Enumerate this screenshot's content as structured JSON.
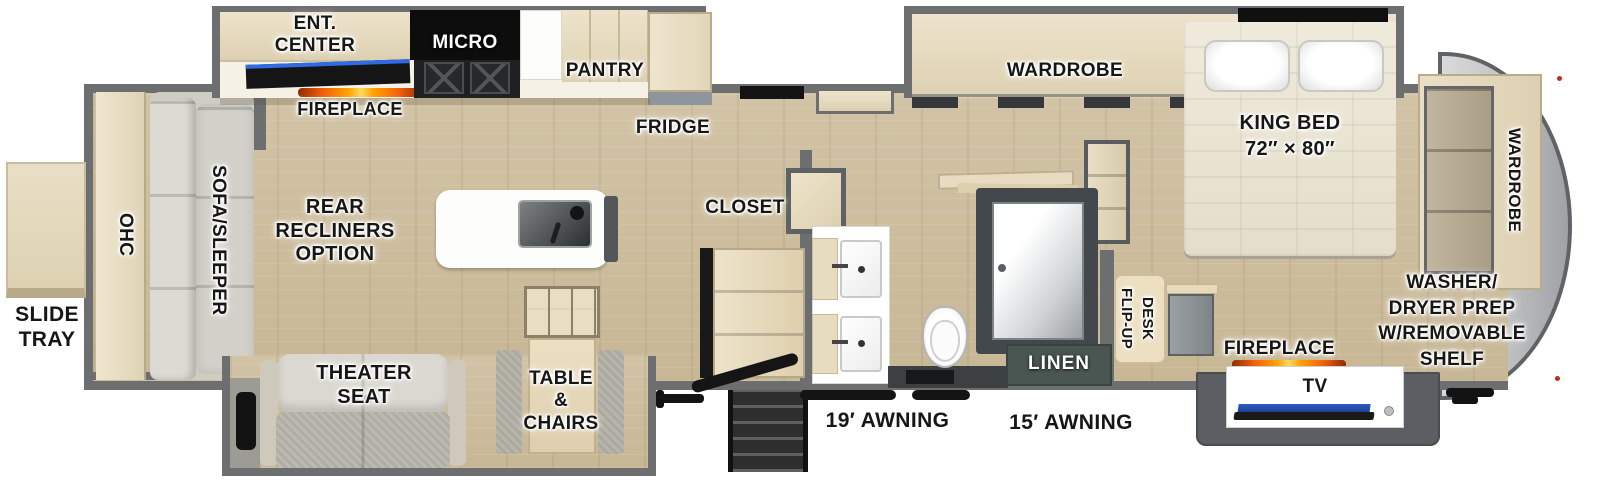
{
  "labels": {
    "slide_tray": "SLIDE\nTRAY",
    "ohc": "OHC",
    "sofa_sleeper": "SOFA/SLEEPER",
    "ent_center": "ENT.\nCENTER",
    "fireplace_kitchen": "FIREPLACE",
    "micro": "MICRO",
    "pantry": "PANTRY",
    "fridge": "FRIDGE",
    "rear_recliners": "REAR\nRECLINERS\nOPTION",
    "closet": "CLOSET",
    "theater_seat": "THEATER\nSEAT",
    "table_chairs": "TABLE\n&\nCHAIRS",
    "awning_19": "19′ AWNING",
    "awning_15": "15′ AWNING",
    "linen": "LINEN",
    "flip_up_desk": "FLIP-UP\nDESK",
    "wardrobe_slide": "WARDROBE",
    "king_bed": "KING BED",
    "king_bed_size": "72″ × 80″",
    "fireplace_bedroom": "FIREPLACE",
    "tv": "TV",
    "washer_dryer": "WASHER/\nDRYER PREP\nW/REMOVABLE\nSHELF",
    "wardrobe_front": "WARDROBE"
  },
  "colors": {
    "wall_gray": "#6d6e70",
    "floor_wood": "#cdbd9f",
    "cabinet_tan": "#e8dec6",
    "flame_orange": "#ffa200",
    "tv_blue": "#2d5bc4",
    "linen_green": "#4a5651",
    "front_cap_gray": "#c3c5c7"
  }
}
